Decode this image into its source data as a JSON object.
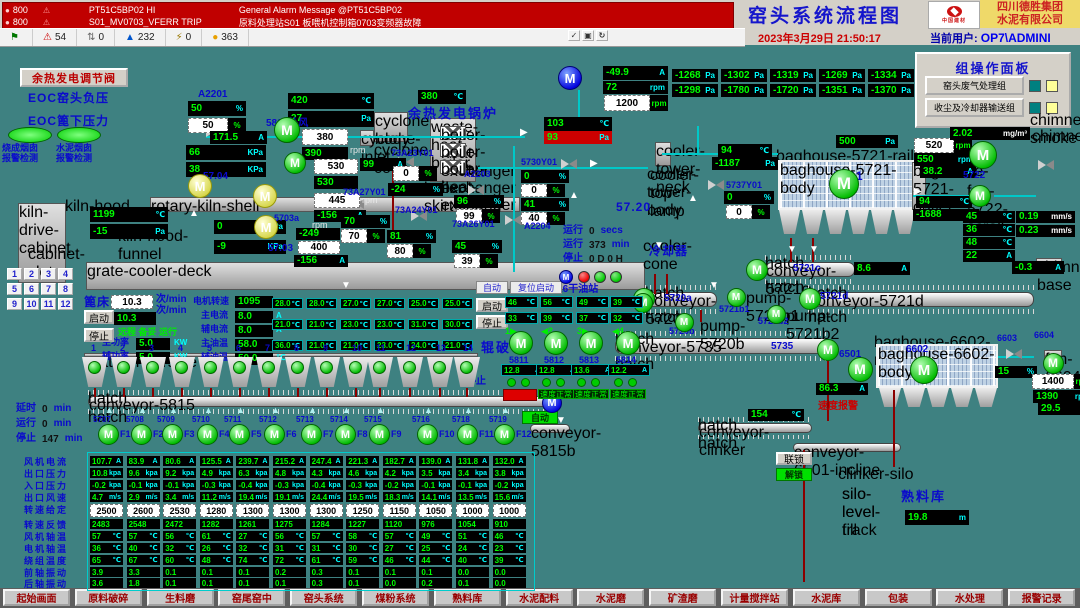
{
  "colors": {
    "background": "#3E8181",
    "value_green": "#00FF00",
    "unit_cyan": "#00FFFF",
    "label_blue": "#0A0ACC",
    "alarm_red": "#C00000",
    "accent_yellow": "#EFD969"
  },
  "alarm_bar": {
    "rows": [
      {
        "station": "800",
        "tag": "PT51C5BP02  HI",
        "message": "General Alarm Message @PT51C5BP02"
      },
      {
        "station": "800",
        "tag": "S01_MV0703_VFERR  TRIP",
        "message": "原料处理站S01 板喂机控制箱0703变频器故障"
      }
    ],
    "status_icons": [
      {
        "name": "flag-icon",
        "glyph": "⚑",
        "color": "#007700",
        "count": ""
      },
      {
        "name": "alarm-bell-icon",
        "glyph": "⚠",
        "color": "#CC0000",
        "count": "54"
      },
      {
        "name": "suppressed-icon",
        "glyph": "⇅",
        "color": "#666666",
        "count": "0"
      },
      {
        "name": "event-up-icon",
        "glyph": "▲",
        "color": "#0055CC",
        "count": "232"
      },
      {
        "name": "fault-icon",
        "glyph": "⚡",
        "color": "#997700",
        "count": "0"
      },
      {
        "name": "warning-icon",
        "glyph": "●",
        "color": "#E8A000",
        "count": "363"
      }
    ],
    "ack_icons": [
      {
        "name": "ack-check-icon",
        "glyph": "✓"
      },
      {
        "name": "ack-page-icon",
        "glyph": "▣"
      },
      {
        "name": "ack-refresh-icon",
        "glyph": "↻"
      }
    ]
  },
  "header": {
    "title": "窑头系统流程图",
    "logo_text": "中国建材",
    "company": [
      "四川德胜集团",
      "水泥有限公司"
    ],
    "datetime": "2023年3月29日  21:50:17",
    "user_label": "当前用户:",
    "user": "OP7\\ADMINI"
  },
  "group_panel": {
    "title": "组操作面板",
    "buttons": [
      "窑头废气处理组",
      "收尘及冷却器输送组"
    ]
  },
  "buttons": {
    "waste_valve": "余热发电调节阀",
    "start": "启动",
    "stop": "停止",
    "auto": "自动",
    "reset_start": "复位启动",
    "interlock": "联锁",
    "unlock": "解锁"
  },
  "motor_letter": "M",
  "labels": {
    "a2201": "A2201",
    "w5803": "5803外风",
    "t5704": "57.04",
    "t5703a": "5703a",
    "t5703": "57.03",
    "v7323": "73A23Y01",
    "v7327": "73A27Y01",
    "v7324": "73A24Y01",
    "a2203": "A2203",
    "v7326": "73A26Y01",
    "v5730": "5730Y01",
    "a2204": "A2204",
    "v5737": "5737Y01",
    "boiler": "余热发电锅炉",
    "cool_id": "57.20",
    "cooler": "冷却器",
    "bh5721": "5721",
    "f5722": "5722",
    "c5721c": "5721c",
    "c5721d": "5721d",
    "c5720a": "5720a",
    "c5720b": "5720b",
    "c5721b1": "5721b1",
    "c5721b2": "5721b2",
    "c5735": "5735",
    "c6501": "6501",
    "bh6602": "6602",
    "v6603": "6603",
    "f6604": "6604",
    "oil": "5816干油站",
    "crusher": "辊破",
    "stop_mid": "停止",
    "c5815": "5815",
    "silo": "熟料库",
    "spd_alarm": "速度报警",
    "eoc1": "EOC窑头负压",
    "eoc2": "EOC篦下压力",
    "smoke1a": "烧成烟囱",
    "smoke1b": "报警检测",
    "smoke2a": "水泥烟囱",
    "smoke2b": "报警检测",
    "rpm": "rpm"
  },
  "gauges": {
    "a2201_pv": [
      "50",
      "%",
      "pv"
    ],
    "a2201_sp": [
      "50",
      "%",
      "sp"
    ],
    "t420": [
      "420",
      "℃",
      "pv"
    ],
    "p27": [
      "27",
      "Pa",
      "pv"
    ],
    "i171": [
      "171.5",
      "A",
      "pv"
    ],
    "sp380": [
      "380",
      "",
      "sp"
    ],
    "v390": [
      "390",
      "",
      "pv"
    ],
    "k66": [
      "66",
      "KPa",
      "pv"
    ],
    "k38": [
      "38",
      "KPa",
      "pv"
    ],
    "sp530": [
      "530",
      "",
      "sp"
    ],
    "i99": [
      "99",
      "A",
      "pv"
    ],
    "v530": [
      "530",
      "",
      "pv"
    ],
    "sp445": [
      "445",
      "",
      "sp"
    ],
    "i156a": [
      "-156",
      "A",
      "pv"
    ],
    "v249": [
      "-249",
      "",
      "pv"
    ],
    "sp400": [
      "400",
      "",
      "sp"
    ],
    "i156b": [
      "-156",
      "A",
      "pv"
    ],
    "k0": [
      "0",
      "KPa",
      "pv"
    ],
    "k9": [
      "-9",
      "KPa",
      "pv"
    ],
    "t1199": [
      "1199",
      "℃",
      "pv"
    ],
    "p15": [
      "-15",
      "Pa",
      "pv"
    ],
    "t380": [
      "380",
      "℃",
      "pv"
    ],
    "v7323sp": [
      "0",
      "%",
      "sp"
    ],
    "v7323pv": [
      "-24",
      "%",
      "pv"
    ],
    "v7327pv": [
      "70",
      "%",
      "pv"
    ],
    "v7327sp": [
      "70",
      "%",
      "sp"
    ],
    "v7324pv": [
      "81",
      "%",
      "pv"
    ],
    "v7324sp": [
      "80",
      "%",
      "sp"
    ],
    "a2203pv": [
      "96",
      "%",
      "pv"
    ],
    "a2203sp": [
      "99",
      "%",
      "sp"
    ],
    "v7326pv": [
      "45",
      "%",
      "pv"
    ],
    "v7326sp": [
      "39",
      "%",
      "sp"
    ],
    "v5730pv1": [
      "0",
      "%",
      "pv"
    ],
    "v5730sp1": [
      "0",
      "%",
      "sp"
    ],
    "v5730pv2": [
      "41",
      "%",
      "pv"
    ],
    "v5730sp2": [
      "40",
      "%",
      "sp"
    ],
    "t103": [
      "103",
      "℃",
      "pv"
    ],
    "p93": [
      "93",
      "Pa",
      "red"
    ],
    "i499": [
      "-49.9",
      "A",
      "pv"
    ],
    "r72": [
      "72",
      "rpm",
      "pv"
    ],
    "sp1200": [
      "1200",
      "rpm",
      "sp"
    ],
    "t94a": [
      "94",
      "℃",
      "pv"
    ],
    "p1187": [
      "-1187",
      "Pa",
      "pv"
    ],
    "v5737pv": [
      "0",
      "%",
      "pv"
    ],
    "v5737sp": [
      "0",
      "%",
      "sp"
    ],
    "p500": [
      "500",
      "Pa",
      "pv"
    ],
    "sp520": [
      "520",
      "rpm",
      "sp"
    ],
    "r550": [
      "550",
      "rpm",
      "pv"
    ],
    "i382": [
      "38.2",
      "A",
      "pv"
    ],
    "t94b": [
      "94",
      "℃",
      "pv"
    ],
    "p1688": [
      "-1688",
      "Pa",
      "pv"
    ],
    "dust": [
      "2.02",
      "mg/m³",
      "pvw"
    ],
    "t45": [
      "45",
      "℃",
      "pv"
    ],
    "t36": [
      "36",
      "℃",
      "pv"
    ],
    "t48": [
      "48",
      "℃",
      "pv"
    ],
    "i22": [
      "22",
      "A",
      "pv"
    ],
    "vib1": [
      "0.19",
      "mm/s",
      "pvw"
    ],
    "vib2": [
      "0.23",
      "mm/s",
      "pvw"
    ],
    "i86": [
      "8.6",
      "A",
      "pv"
    ],
    "im03": [
      "-0.3",
      "A",
      "pv"
    ],
    "i863": [
      "86.3",
      "A",
      "pv"
    ],
    "pc15": [
      "15",
      "%",
      "pv"
    ],
    "sp1400": [
      "1400",
      "rpm",
      "sp"
    ],
    "r1390": [
      "1390",
      "rpm",
      "pv"
    ],
    "i295": [
      "29.5",
      "A",
      "pv"
    ],
    "t154": [
      "154",
      "℃",
      "pv"
    ],
    "silo_lvl": [
      "19.8",
      "m",
      "pv"
    ],
    "bed_sp": [
      "10.3",
      "",
      "sp"
    ],
    "bed_pv": [
      "10.3",
      "",
      "pv"
    ],
    "pw1": [
      "5.0",
      "",
      "pv"
    ],
    "pw2": [
      "5.0",
      "",
      "pv"
    ],
    "r1095": [
      "1095",
      "",
      "pv"
    ],
    "cur1": [
      "8.0",
      "",
      "pv"
    ],
    "cur2": [
      "8.0",
      "",
      "pv"
    ],
    "oil1": [
      "58.0",
      "",
      "pv"
    ],
    "oil2": [
      "50.0",
      "",
      "pv"
    ]
  },
  "pressure_grid": {
    "unit": "Pa",
    "rows": [
      [
        "-1268",
        "-1302",
        "-1319",
        "-1269",
        "-1334"
      ],
      [
        "-1298",
        "-1780",
        "-1720",
        "-1351",
        "-1370"
      ]
    ]
  },
  "grate": {
    "bed_label": "篦床",
    "bed_unit": "次/min",
    "status_text": "远程 备妥 运行",
    "fields": [
      {
        "label": "主功率",
        "unit": "KW"
      },
      {
        "label": "辅功率",
        "unit": "KW"
      },
      {
        "label": "电机转速",
        "unit": "rpm"
      },
      {
        "label": "主电流",
        "unit": "A"
      },
      {
        "label": "辅电流",
        "unit": "A"
      },
      {
        "label": "主油温",
        "unit": "℃"
      },
      {
        "label": "辅油温",
        "unit": "℃"
      }
    ],
    "temp_unit": "℃",
    "temp_grid": [
      [
        "28.0",
        "28.0",
        "27.0",
        "27.0",
        "25.0",
        "25.0"
      ],
      [
        "21.0",
        "21.0",
        "23.0",
        "23.0",
        "31.0",
        "30.0"
      ],
      [
        "36.0",
        "21.0",
        "21.0",
        "23.0",
        "24.0",
        "21.0"
      ]
    ],
    "hopper_numbers": [
      "1",
      "2",
      "3",
      "4",
      "5",
      "6",
      "7",
      "8",
      "9",
      "10",
      "11",
      "12",
      "13",
      "14"
    ]
  },
  "keypad": [
    "1",
    "2",
    "3",
    "4",
    "5",
    "6",
    "7",
    "8",
    "9",
    "10",
    "11",
    "12"
  ],
  "oil_station": {
    "temps": [
      [
        "46",
        "56",
        "49",
        "39"
      ],
      [
        "33",
        "39",
        "37",
        "32"
      ]
    ],
    "unit": "℃",
    "ports": [
      "1▶",
      "◀2",
      "3▶",
      "◀4"
    ]
  },
  "crushers": {
    "units": [
      {
        "id": "5811",
        "amp": "12.8"
      },
      {
        "id": "5812",
        "amp": "12.8"
      },
      {
        "id": "5813",
        "amp": "13.6"
      },
      {
        "id": "5814",
        "amp": "12.2"
      }
    ],
    "amp_unit": "A",
    "ok_text": "速度正常"
  },
  "timers_left": [
    {
      "label": "延时",
      "value": "0",
      "unit": "min"
    },
    {
      "label": "运行",
      "value": "0",
      "unit": "min"
    },
    {
      "label": "停止",
      "value": "147",
      "unit": "min"
    }
  ],
  "cooler_timers": [
    {
      "label": "运行",
      "value": "0",
      "unit": "secs"
    },
    {
      "label": "运行",
      "value": "373",
      "unit": "min"
    },
    {
      "label": "停止",
      "value": "0  D  0  H",
      "unit": ""
    }
  ],
  "fans_row": {
    "conveyor_id": "5815",
    "items": [
      {
        "id": "5707",
        "f": "F1"
      },
      {
        "id": "5708",
        "f": "F2"
      },
      {
        "id": "5709",
        "f": "F3"
      },
      {
        "id": "5710",
        "f": "F4"
      },
      {
        "id": "5711",
        "f": "F5"
      },
      {
        "id": "5712",
        "f": "F6"
      },
      {
        "id": "5713",
        "f": "F7"
      },
      {
        "id": "5714",
        "f": "F8"
      },
      {
        "id": "5715",
        "f": "F9"
      },
      {
        "id": "5716",
        "f": "F10"
      },
      {
        "id": "5718",
        "f": "F11"
      },
      {
        "id": "5719",
        "f": "F12"
      }
    ]
  },
  "fan_table": {
    "rows": [
      {
        "label": "风机电流",
        "unit": "A",
        "kind": "pv",
        "values": [
          "107.7",
          "83.9",
          "80.6",
          "125.5",
          "239.7",
          "215.2",
          "247.4",
          "221.3",
          "182.7",
          "139.0",
          "131.8",
          "132.0"
        ]
      },
      {
        "label": "出口压力",
        "unit": "kpa",
        "kind": "pv",
        "values": [
          "10.8",
          "9.6",
          "9.2",
          "4.9",
          "6.3",
          "4.8",
          "4.3",
          "4.6",
          "4.2",
          "3.5",
          "3.4",
          "3.8"
        ]
      },
      {
        "label": "入口压力",
        "unit": "kpa",
        "kind": "pv",
        "values": [
          "-0.2",
          "-0.1",
          "-0.1",
          "-0.3",
          "-0.4",
          "-0.3",
          "-0.4",
          "-0.3",
          "-0.2",
          "-0.1",
          "-0.1",
          "-0.2"
        ]
      },
      {
        "label": "出口风速",
        "unit": "m/s",
        "kind": "pv",
        "values": [
          "4.7",
          "2.9",
          "3.4",
          "11.2",
          "19.4",
          "19.1",
          "24.4",
          "19.5",
          "18.3",
          "14.1",
          "13.5",
          "15.6"
        ]
      },
      {
        "label": "转速给定",
        "unit": "",
        "kind": "sp",
        "values": [
          "2500",
          "2600",
          "2530",
          "1280",
          "1300",
          "1300",
          "1300",
          "1250",
          "1150",
          "1050",
          "1000",
          "1000"
        ]
      },
      {
        "label": "转速反馈",
        "unit": "",
        "kind": "pv",
        "values": [
          "2483",
          "2548",
          "2472",
          "1282",
          "1261",
          "1275",
          "1284",
          "1227",
          "1120",
          "976",
          "1054",
          "910"
        ]
      },
      {
        "label": "风机轴温",
        "unit": "℃",
        "kind": "pv",
        "values": [
          "57",
          "57",
          "56",
          "61",
          "27",
          "56",
          "57",
          "58",
          "57",
          "49",
          "51",
          "46"
        ]
      },
      {
        "label": "电机轴温",
        "unit": "℃",
        "kind": "pv",
        "values": [
          "36",
          "40",
          "32",
          "26",
          "32",
          "31",
          "31",
          "30",
          "27",
          "25",
          "24",
          "23"
        ]
      },
      {
        "label": "绕组温度",
        "unit": "℃",
        "kind": "pv",
        "values": [
          "65",
          "67",
          "60",
          "48",
          "74",
          "72",
          "61",
          "59",
          "46",
          "44",
          "40",
          "39"
        ]
      },
      {
        "label": "前轴振动",
        "unit": "",
        "kind": "pv",
        "values": [
          "3.9",
          "3.3",
          "0.1",
          "0.1",
          "0.1",
          "0.2",
          "0.3",
          "0.1",
          "0.1",
          "0.1",
          "0.0",
          "0.0"
        ]
      },
      {
        "label": "后轴振动",
        "unit": "",
        "kind": "pv",
        "values": [
          "3.6",
          "1.8",
          "0.1",
          "0.1",
          "0.1",
          "0.1",
          "0.3",
          "0.1",
          "0.0",
          "0.2",
          "0.1",
          "0.0"
        ]
      }
    ]
  },
  "silo": {
    "name": "熟料库"
  },
  "nav": [
    "起始画面",
    "原料破碎",
    "生料磨",
    "窑尾窑中",
    "窑头系统",
    "煤粉系统",
    "熟料库",
    "水泥配料",
    "水泥磨",
    "矿渣磨",
    "计量搅拌站",
    "水泥库",
    "包装",
    "水处理",
    "报警记录"
  ]
}
